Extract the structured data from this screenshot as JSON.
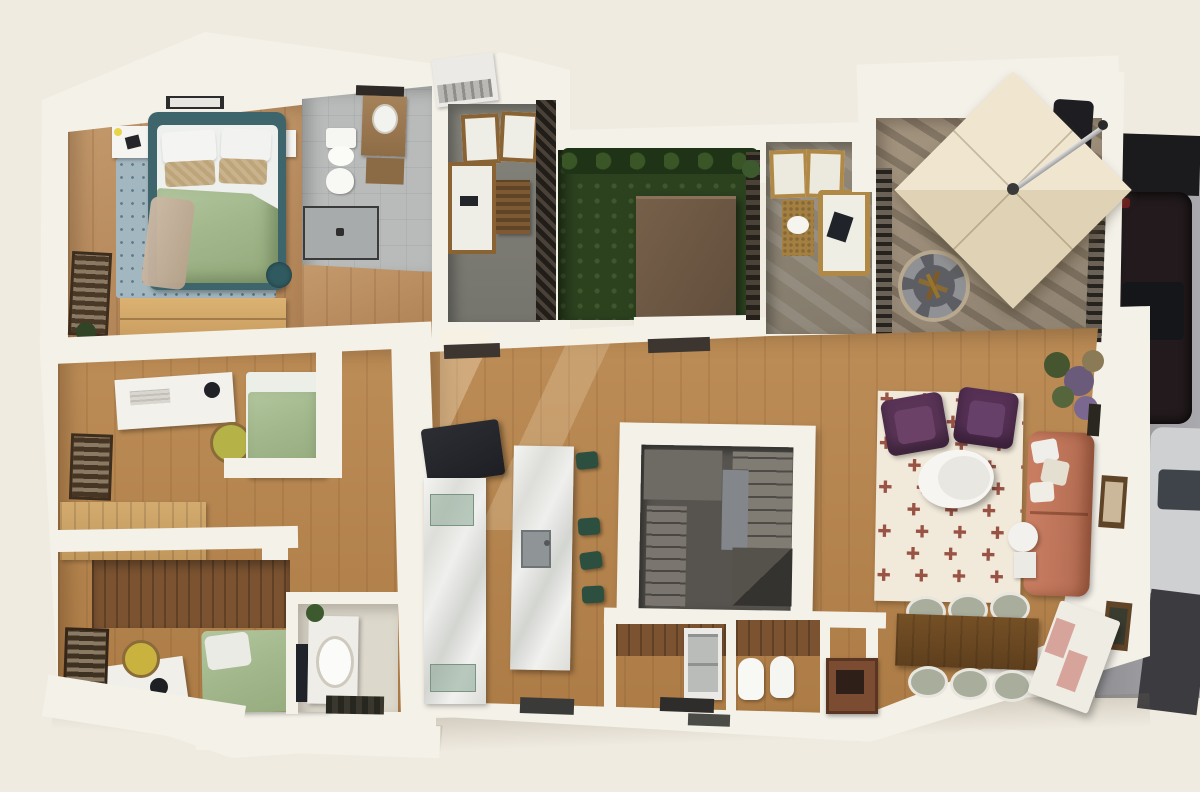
{
  "scene": {
    "type": "3d-floor-plan-render",
    "text_content": "none"
  },
  "palette": {
    "bg": "#f0ebe1",
    "wall": "#f4f1e9",
    "wall-shade": "#dcd5c6",
    "wood": "#ad7c46",
    "wood-hi": "#bd8d57",
    "woodwall": "#7b5331",
    "tile": "#b8bbba",
    "concrete": "#7c7b74",
    "grass": "#2c421f",
    "deck": "#9c8e7b",
    "street": "#98989c",
    "bluerug": "#a3b7c0",
    "teal": "#3e656b",
    "sagegreen": "#a8bc92",
    "coral": "#c0745a",
    "plum": "#5a3457",
    "rugcream": "#f1e9da",
    "rugred": "#8a3a2c",
    "canopy": "#ece1c8",
    "canvasbrown": "#6b5642",
    "stoolgreen": "#2c4f3f"
  },
  "rug": {
    "motif": "✚",
    "rows": 9,
    "cols": 6
  }
}
